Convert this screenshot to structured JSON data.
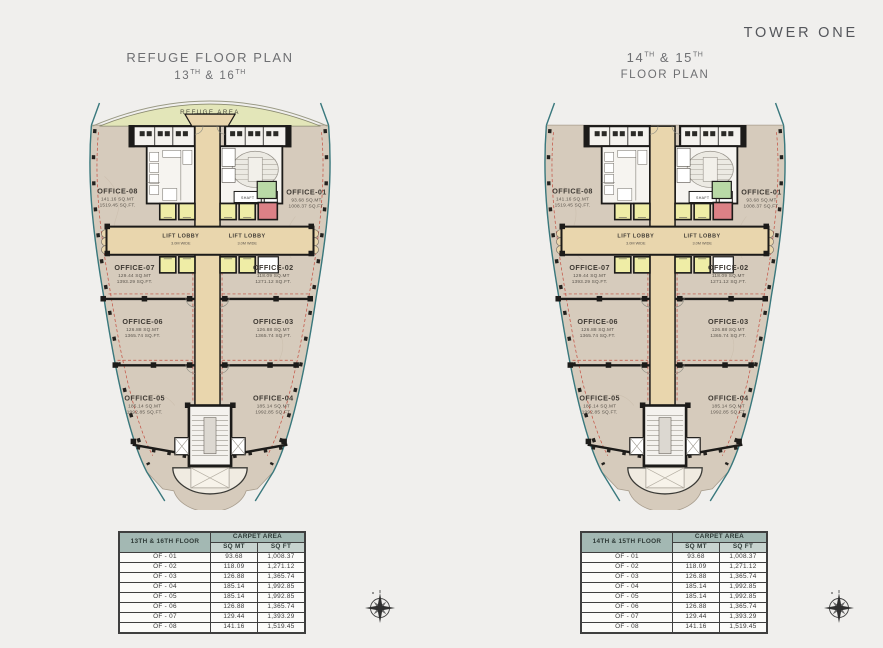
{
  "brand": "TOWER ONE",
  "left": {
    "title1": "REFUGE FLOOR PLAN",
    "t2a": "13",
    "t2asup": "TH",
    "t2b": " & 16",
    "t2bsup": "TH",
    "refuge": "REFUGE AREA",
    "lobby": "LIFT LOBBY",
    "lobby_w": "3.0M WIDE",
    "shaft": "SHAFT",
    "offices": {
      "o1": {
        "name": "OFFICE-01",
        "mt": "93.68 SQ.MT",
        "ft": "1008.37 SQ.FT."
      },
      "o2": {
        "name": "OFFICE-02",
        "mt": "118.09 SQ.MT",
        "ft": "1271.12 SQ.FT."
      },
      "o3": {
        "name": "OFFICE-03",
        "mt": "126.88 SQ.MT",
        "ft": "1365.74 SQ.FT."
      },
      "o4": {
        "name": "OFFICE-04",
        "mt": "185.14 SQ.MT",
        "ft": "1992.85 SQ.FT."
      },
      "o5": {
        "name": "OFFICE-05",
        "mt": "185.14 SQ.MT",
        "ft": "1992.85 SQ.FT."
      },
      "o6": {
        "name": "OFFICE-06",
        "mt": "126.88 SQ.MT",
        "ft": "1365.74 SQ.FT."
      },
      "o7": {
        "name": "OFFICE-07",
        "mt": "129.44 SQ.MT",
        "ft": "1393.29 SQ.FT."
      },
      "o8": {
        "name": "OFFICE-08",
        "mt": "141.16 SQ.MT",
        "ft": "1519.45 SQ.FT."
      }
    }
  },
  "right": {
    "t1a": "14",
    "t1asup": "TH",
    "t1b": " & 15",
    "t1bsup": "TH",
    "title2": "FLOOR PLAN",
    "lobby": "LIFT LOBBY",
    "lobby_w": "3.0M WIDE",
    "shaft": "SHAFT",
    "offices": {
      "o1": {
        "name": "OFFICE-01",
        "mt": "93.68 SQ.MT",
        "ft": "1008.37 SQ.FT."
      },
      "o2": {
        "name": "OFFICE-02",
        "mt": "118.09 SQ.MT",
        "ft": "1271.12 SQ.FT."
      },
      "o3": {
        "name": "OFFICE-03",
        "mt": "126.88 SQ.MT",
        "ft": "1365.74 SQ.FT."
      },
      "o4": {
        "name": "OFFICE-04",
        "mt": "185.14 SQ.MT",
        "ft": "1992.85 SQ.FT."
      },
      "o5": {
        "name": "OFFICE-05",
        "mt": "185.14 SQ.MT",
        "ft": "1992.85 SQ.FT."
      },
      "o6": {
        "name": "OFFICE-06",
        "mt": "126.88 SQ.MT",
        "ft": "1365.74 SQ.FT."
      },
      "o7": {
        "name": "OFFICE-07",
        "mt": "129.44 SQ.MT",
        "ft": "1393.29 SQ.FT."
      },
      "o8": {
        "name": "OFFICE-08",
        "mt": "141.16 SQ.MT",
        "ft": "1519.45 SQ.FT."
      }
    }
  },
  "left_table": {
    "floor": "13TH & 16TH FLOOR",
    "carpet": "CARPET AREA",
    "sqmt": "SQ MT",
    "sqft": "SQ FT",
    "rows": [
      [
        "OF - 01",
        "93.68",
        "1,008.37"
      ],
      [
        "OF - 02",
        "118.09",
        "1,271.12"
      ],
      [
        "OF - 03",
        "126.88",
        "1,365.74"
      ],
      [
        "OF - 04",
        "185.14",
        "1,992.85"
      ],
      [
        "OF - 05",
        "185.14",
        "1,992.85"
      ],
      [
        "OF - 06",
        "126.88",
        "1,365.74"
      ],
      [
        "OF - 07",
        "129.44",
        "1,393.29"
      ],
      [
        "OF - 08",
        "141.16",
        "1,519.45"
      ]
    ]
  },
  "right_table": {
    "floor": "14TH & 15TH FLOOR",
    "carpet": "CARPET AREA",
    "sqmt": "SQ MT",
    "sqft": "SQ FT",
    "rows": [
      [
        "OF - 01",
        "93.68",
        "1,008.37"
      ],
      [
        "OF - 02",
        "118.09",
        "1,271.12"
      ],
      [
        "OF - 03",
        "126.88",
        "1,365.74"
      ],
      [
        "OF - 04",
        "185.14",
        "1,992.85"
      ],
      [
        "OF - 05",
        "185.14",
        "1,992.85"
      ],
      [
        "OF - 06",
        "126.88",
        "1,365.74"
      ],
      [
        "OF - 07",
        "129.44",
        "1,393.29"
      ],
      [
        "OF - 08",
        "141.16",
        "1,519.45"
      ]
    ]
  },
  "colors": {
    "background": "#f0efed",
    "marble": "#d6cbbc",
    "wall": "#1c1b19",
    "glass_teal": "#39787d",
    "corridor_tan": "#e9d6ad",
    "lift_yellow": "#efeda6",
    "fire_lift_red": "#dc8186",
    "green_room": "#b9d9a6",
    "refuge_green": "#e3e6b9",
    "table_header_teal": "#a3b8b3",
    "carpet_dashed_red": "#c0392b"
  }
}
